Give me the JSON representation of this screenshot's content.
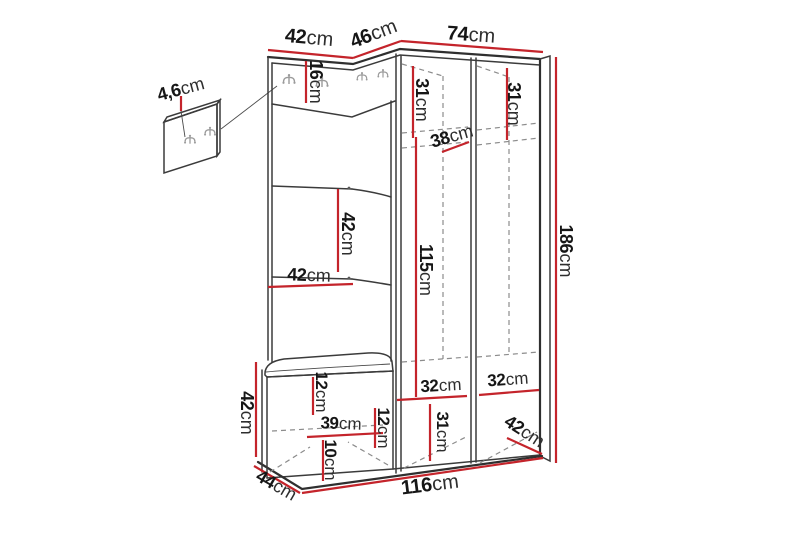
{
  "figure": {
    "title": "Hallway furniture set dimension diagram",
    "unit": "cm",
    "colors": {
      "dimension_line": "#c4242b",
      "outline": "#3b3b3b",
      "hidden_line": "#8c8c8c",
      "label_text": "#161616",
      "background": "#ffffff"
    },
    "labels": [
      {
        "name": "wall-panel-depth",
        "value": "4,6",
        "unit": "cm"
      },
      {
        "name": "left-section-top-width",
        "value": "42",
        "unit": "cm"
      },
      {
        "name": "corner-section-width",
        "value": "46",
        "unit": "cm"
      },
      {
        "name": "right-section-top-width",
        "value": "74",
        "unit": "cm"
      },
      {
        "name": "hook-strip-height",
        "value": "16",
        "unit": "cm"
      },
      {
        "name": "left-compartment-top-width",
        "value": "31",
        "unit": "cm"
      },
      {
        "name": "right-compartment-top-width",
        "value": "31",
        "unit": "cm"
      },
      {
        "name": "top-shelf-depth",
        "value": "38",
        "unit": "cm"
      },
      {
        "name": "panel-section-height",
        "value": "42",
        "unit": "cm"
      },
      {
        "name": "panel-niche-width",
        "value": "42",
        "unit": "cm"
      },
      {
        "name": "interior-height",
        "value": "115",
        "unit": "cm"
      },
      {
        "name": "total-height",
        "value": "186",
        "unit": "cm"
      },
      {
        "name": "bench-height",
        "value": "42",
        "unit": "cm"
      },
      {
        "name": "bench-top-offset",
        "value": "12",
        "unit": "cm"
      },
      {
        "name": "bench-interior-width",
        "value": "39",
        "unit": "cm"
      },
      {
        "name": "bench-shelf-offset",
        "value": "12",
        "unit": "cm"
      },
      {
        "name": "bench-base-height",
        "value": "10",
        "unit": "cm"
      },
      {
        "name": "left-compartment-bottom-width",
        "value": "32",
        "unit": "cm"
      },
      {
        "name": "right-compartment-bottom-width",
        "value": "32",
        "unit": "cm"
      },
      {
        "name": "bottom-compartment-height",
        "value": "31",
        "unit": "cm"
      },
      {
        "name": "wardrobe-depth",
        "value": "42",
        "unit": "cm"
      },
      {
        "name": "bench-depth",
        "value": "44",
        "unit": "cm"
      },
      {
        "name": "total-width",
        "value": "116",
        "unit": "cm"
      }
    ]
  }
}
